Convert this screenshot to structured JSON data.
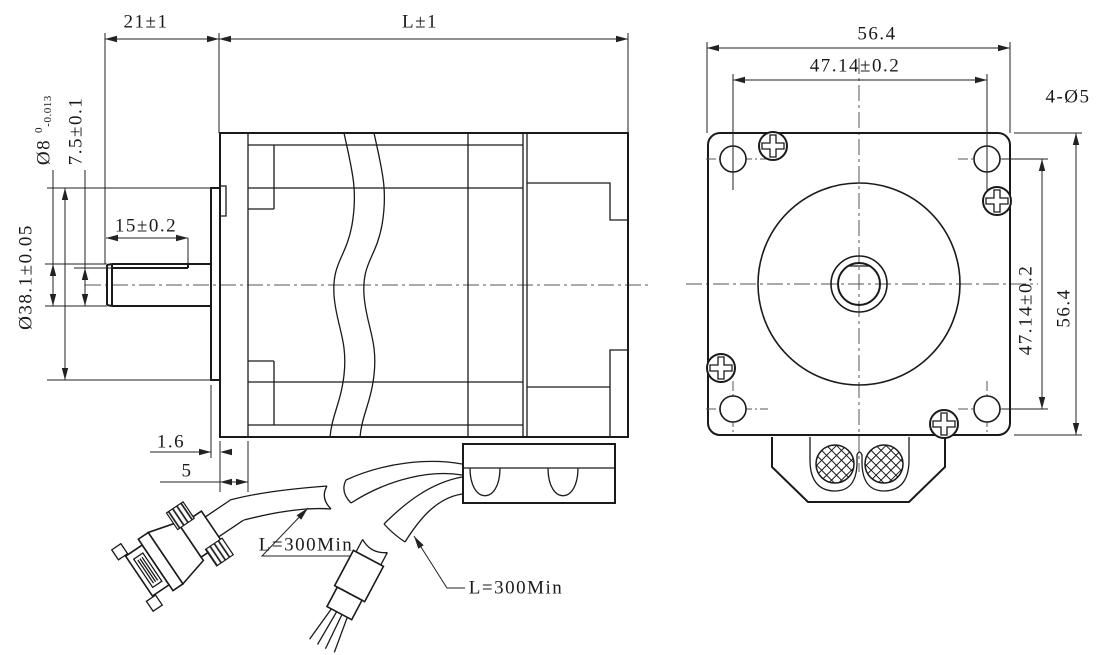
{
  "drawing": {
    "title": "stepper-motor-dimensional-drawing",
    "side_view": {
      "shaft_extension": "21±1",
      "body_length": "L±1",
      "shaft_diameter": "Ø8",
      "shaft_diameter_tol_upper": "0",
      "shaft_diameter_tol_lower": "-0.013",
      "shaft_flat_height": "7.5±0.1",
      "shaft_flat_length": "15±0.2",
      "pilot_diameter": "Ø38.1±0.05",
      "pilot_boss_depth": "1.6",
      "front_step_depth": "5",
      "dsub_cable_length": "L=300Min",
      "wire_cable_length": "L=300Min"
    },
    "front_view": {
      "body_width": "56.4",
      "hole_spacing_horizontal": "47.14±0.2",
      "mounting_holes": "4-Ø5",
      "hole_spacing_vertical": "47.14±0.2",
      "body_height": "56.4"
    },
    "colors": {
      "line": "#1a1a1a",
      "dimension": "#222222",
      "background": "#ffffff"
    }
  }
}
